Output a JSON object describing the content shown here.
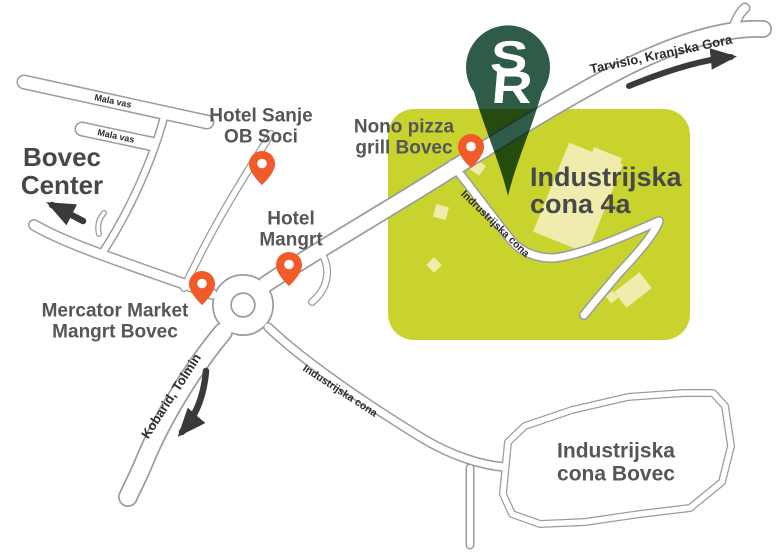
{
  "colors": {
    "zone_fill": "#C9D32E",
    "building_fill": "#F0ECAE",
    "marker_green": "#2E5C49",
    "pin_orange": "#F15A29",
    "road_casing": "#9C9C9C",
    "road_fill": "#FFFFFF",
    "label_dark": "#54565A",
    "label_darker": "#47484A",
    "road_label": "#2B2B2D",
    "arrow_dark": "#3A3A3C"
  },
  "marker": {
    "logo_line1": "S",
    "logo_line2": "R"
  },
  "areas": {
    "zone_4a": {
      "label": "Industrijska\ncona 4a"
    },
    "zone_bovec": {
      "label": "Industrijska\ncona Bovec"
    }
  },
  "pois": {
    "hotel_sanje": {
      "label": "Hotel Sanje\nOB Soci"
    },
    "nono_pizza": {
      "label": "Nono pizza\ngrill Bovec"
    },
    "hotel_mangrt": {
      "label": "Hotel\nMangrt"
    },
    "mercator": {
      "label": "Mercator Market\nMangrt Bovec"
    }
  },
  "directions": {
    "bovec_center": {
      "label": "Bovec\nCenter"
    },
    "tarvisio": {
      "label": "Tarvisio, Kranjska Gora"
    },
    "kobarid": {
      "label": "Kobarid, Tolmin"
    }
  },
  "road_labels": {
    "mala_vas_upper": "Mala vas",
    "mala_vas_lower": "Mala vas",
    "zone_road": "Indrustrijska cona",
    "south_road": "Industrijska cona"
  }
}
